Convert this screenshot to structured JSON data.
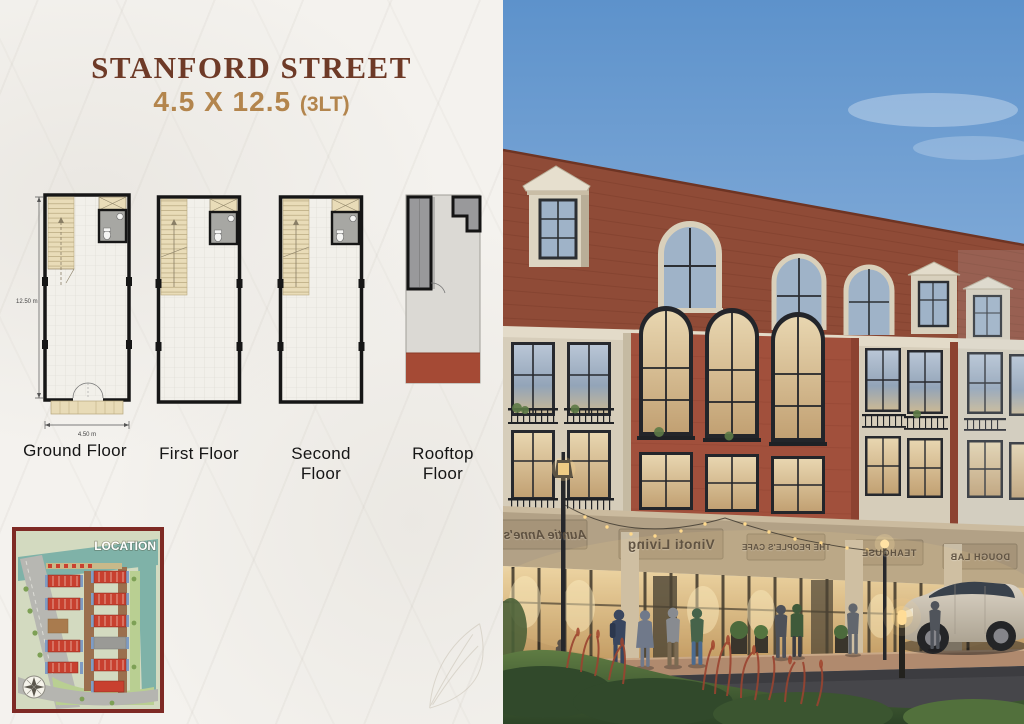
{
  "brochure": {
    "title": "STANFORD STREET",
    "subtitle": "4.5 X 12.5",
    "subtitle_suffix": "(3LT)"
  },
  "floor_plans": {
    "height_dim": "12.50 m",
    "width_dim": "4.50 m",
    "plans": [
      {
        "label": "Ground Floor"
      },
      {
        "label": "First Floor"
      },
      {
        "label": "Second Floor"
      },
      {
        "label": "Rooftop Floor"
      }
    ]
  },
  "location_map": {
    "title": "LOCATION"
  },
  "street_view": {
    "signs": [
      {
        "name": "Auntie Anne's"
      },
      {
        "name": "Vinoti Living"
      },
      {
        "name": "THE PEOPLE'S CAFE"
      },
      {
        "name": "TEAHOUSE"
      },
      {
        "name": "DOUGH LAB"
      }
    ]
  },
  "colors": {
    "title_brown": "#6e3a27",
    "accent_gold": "#b3854d",
    "map_border": "#7e2a24",
    "roof_tile": "#8f4b37",
    "brick": "#a1503c",
    "stone": "#d8cfc0"
  }
}
